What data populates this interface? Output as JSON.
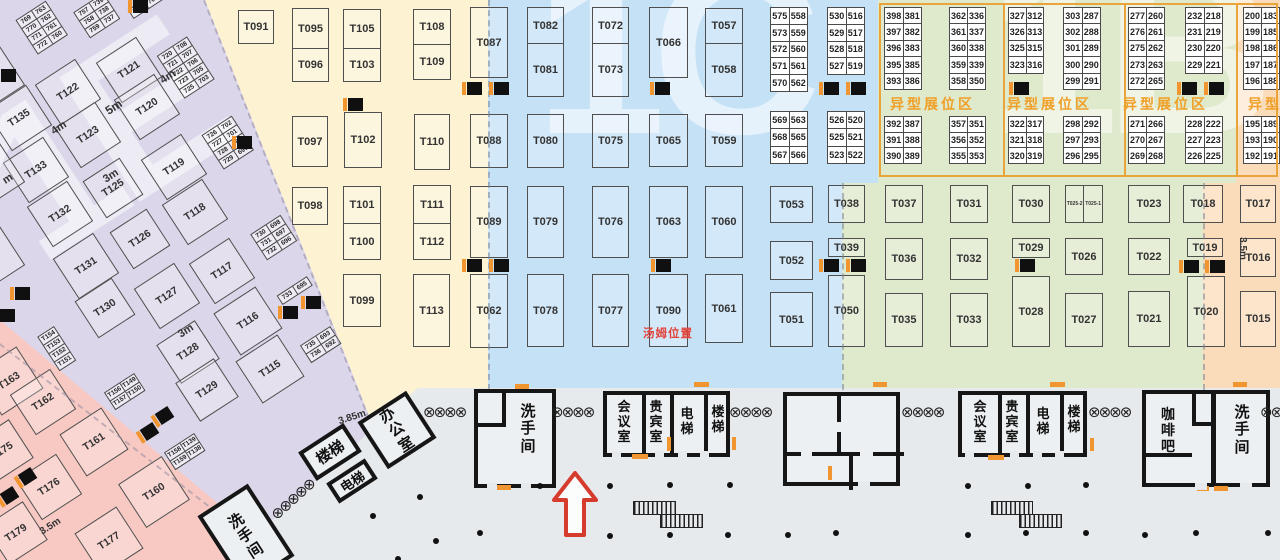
{
  "title": "exhibition-hall-floorplan",
  "tom_label": "汤姆位置",
  "watermarks": [
    "1E",
    "1C",
    "1B"
  ],
  "special_zone_label": "异型展位区",
  "special_labels": [
    [
      890,
      94
    ],
    [
      1007,
      94
    ],
    [
      1123,
      94
    ],
    [
      1248,
      94
    ]
  ],
  "zones": [
    {
      "name": "left-hall-purple",
      "color": "#dbd6e9"
    },
    {
      "name": "left-corner-pink",
      "color": "#f8c9c3"
    },
    {
      "name": "yellow-zone",
      "color": "#fdf3d3"
    },
    {
      "name": "blue-zone-1c",
      "color": "#c5e1f6"
    },
    {
      "name": "green-zone",
      "color": "#dfe9cb"
    },
    {
      "name": "orange-zone-1b",
      "color": "#fbdcba"
    },
    {
      "name": "walkway-gray",
      "color": "#e7eaed"
    },
    {
      "name": "accent-orange",
      "color": "#f0952f"
    },
    {
      "name": "marker-red",
      "color": "#e2443b"
    }
  ],
  "booths": [
    [
      "T091",
      238,
      10,
      36,
      34
    ],
    [
      "T097",
      292,
      116,
      36,
      51
    ],
    [
      "T102",
      344,
      112,
      38,
      56
    ],
    [
      "T110",
      414,
      114,
      36,
      56
    ],
    [
      "T098",
      292,
      187,
      36,
      38
    ],
    [
      "T099",
      343,
      274,
      38,
      53
    ],
    [
      "T113",
      413,
      274,
      37,
      73
    ],
    [
      "T087",
      470,
      7,
      38,
      71
    ],
    [
      "T088",
      470,
      114,
      38,
      54
    ],
    [
      "T089",
      470,
      186,
      38,
      72
    ],
    [
      "T062",
      470,
      274,
      38,
      74
    ],
    [
      "T080",
      527,
      114,
      37,
      54
    ],
    [
      "T079",
      527,
      186,
      37,
      72
    ],
    [
      "T078",
      527,
      274,
      37,
      73
    ],
    [
      "T075",
      592,
      114,
      37,
      54
    ],
    [
      "T076",
      592,
      186,
      37,
      72
    ],
    [
      "T077",
      592,
      274,
      37,
      73
    ],
    [
      "T066",
      649,
      7,
      39,
      71
    ],
    [
      "T065",
      649,
      114,
      39,
      53
    ],
    [
      "T063",
      649,
      186,
      39,
      72
    ],
    [
      "T090",
      649,
      274,
      39,
      73
    ],
    [
      "T059",
      705,
      114,
      38,
      53
    ],
    [
      "T060",
      705,
      186,
      38,
      72
    ],
    [
      "T061",
      705,
      274,
      38,
      69
    ],
    [
      "T053",
      770,
      186,
      43,
      37
    ],
    [
      "T052",
      770,
      241,
      43,
      39
    ],
    [
      "T051",
      770,
      292,
      43,
      55
    ],
    [
      "T038",
      828,
      185,
      37,
      38
    ],
    [
      "T039",
      828,
      238,
      37,
      19
    ],
    [
      "T050",
      828,
      275,
      37,
      72
    ],
    [
      "T037",
      885,
      185,
      38,
      38
    ],
    [
      "T036",
      885,
      238,
      38,
      42
    ],
    [
      "T035",
      885,
      293,
      38,
      54
    ],
    [
      "T031",
      950,
      185,
      38,
      38
    ],
    [
      "T032",
      950,
      238,
      38,
      42
    ],
    [
      "T033",
      950,
      293,
      38,
      54
    ],
    [
      "T030",
      1012,
      185,
      38,
      38
    ],
    [
      "T029",
      1012,
      238,
      38,
      20
    ],
    [
      "T028",
      1012,
      276,
      38,
      71
    ],
    [
      "T026",
      1065,
      238,
      38,
      37
    ],
    [
      "T027",
      1065,
      293,
      38,
      54
    ],
    [
      "T023",
      1128,
      185,
      42,
      38
    ],
    [
      "T022",
      1128,
      238,
      42,
      37
    ],
    [
      "T021",
      1128,
      291,
      42,
      56
    ],
    [
      "T018",
      1183,
      185,
      40,
      38
    ],
    [
      "T019",
      1187,
      238,
      36,
      19
    ],
    [
      "T020",
      1187,
      276,
      38,
      71
    ],
    [
      "T017",
      1240,
      185,
      36,
      38
    ],
    [
      "T016",
      1240,
      238,
      36,
      39
    ],
    [
      "T015",
      1240,
      291,
      36,
      56
    ]
  ],
  "booth_pairs": [
    [
      "T095",
      "T096",
      292,
      8,
      37,
      74,
      40
    ],
    [
      "T105",
      "T103",
      343,
      9,
      38,
      73,
      39
    ],
    [
      "T108",
      "T109",
      413,
      9,
      38,
      71,
      35
    ],
    [
      "T101",
      "T100",
      343,
      186,
      38,
      74,
      37
    ],
    [
      "T111",
      "T112",
      413,
      185,
      38,
      75,
      38
    ],
    [
      "T082",
      "T081",
      527,
      7,
      37,
      90,
      36
    ],
    [
      "T072",
      "T073",
      592,
      7,
      37,
      90,
      36
    ],
    [
      "T057",
      "T058",
      705,
      8,
      38,
      89,
      35
    ]
  ],
  "booth_hpair": [
    "T025-2",
    "T025-1",
    1065,
    185,
    38,
    38
  ],
  "rot_booths": [
    [
      "T121",
      129,
      70,
      48
    ],
    [
      "T122",
      68,
      92,
      48
    ],
    [
      "T120",
      147,
      107,
      48
    ],
    [
      "T135",
      19,
      118,
      48
    ],
    [
      "T123",
      88,
      135,
      48
    ],
    [
      "T133",
      36,
      170,
      48
    ],
    [
      "T119",
      174,
      167,
      48
    ],
    [
      "T125",
      113,
      188,
      44
    ],
    [
      "T132",
      60,
      214,
      48
    ],
    [
      "T118",
      195,
      212,
      48
    ],
    [
      "T126",
      140,
      239,
      44
    ],
    [
      "T131",
      86,
      266,
      48
    ],
    [
      "T117",
      222,
      271,
      48
    ],
    [
      "T127",
      167,
      296,
      48
    ],
    [
      "T130",
      105,
      308,
      44
    ],
    [
      "T128",
      188,
      352,
      46
    ],
    [
      "T129",
      207,
      390,
      46
    ],
    [
      "T116",
      248,
      321,
      50
    ],
    [
      "T115",
      270,
      369,
      50
    ],
    [
      "",
      -8,
      78,
      48
    ],
    [
      "",
      -8,
      175,
      48
    ],
    [
      "",
      -8,
      258,
      48
    ],
    [
      "T163",
      9,
      381,
      50
    ],
    [
      "T162",
      43,
      402,
      48
    ],
    [
      "T161",
      94,
      442,
      50
    ],
    [
      "T160",
      154,
      492,
      52
    ],
    [
      "T175",
      2,
      451,
      46
    ],
    [
      "T176",
      49,
      487,
      48
    ],
    [
      "T179",
      16,
      533,
      46
    ],
    [
      "T177",
      109,
      541,
      50
    ]
  ],
  "rot_strips": [
    [
      42,
      28,
      [
        "769|763",
        "770|762",
        "771|761",
        "772|760"
      ]
    ],
    [
      97,
      16,
      [
        "757|739",
        "758|738",
        "759|737"
      ]
    ],
    [
      146,
      5,
      [
        "719|709"
      ]
    ],
    [
      186,
      68,
      [
        "720|708",
        "721|707",
        "722|706",
        "723|705",
        "725|703"
      ]
    ],
    [
      228,
      143,
      [
        "726|702",
        "727|701",
        "728|700",
        "729|699"
      ]
    ],
    [
      274,
      238,
      [
        "730|698",
        "731|697",
        "732|696"
      ]
    ],
    [
      295,
      291,
      [
        "733|695"
      ]
    ],
    [
      321,
      345,
      [
        "735|693",
        "736|692"
      ]
    ],
    [
      57,
      349,
      [
        "T154",
        "T153",
        "T152",
        "T151"
      ]
    ],
    [
      125,
      392,
      [
        "T156|T149",
        "T157|T150"
      ]
    ],
    [
      185,
      452,
      [
        "T158|T139",
        "T159|T138"
      ]
    ]
  ],
  "num_blocks": [
    [
      770,
      8,
      38,
      17.8,
      [
        "575|558",
        "573|559",
        "572|560",
        "571|561",
        "570|562"
      ]
    ],
    [
      827,
      8,
      38,
      17.8,
      [
        "530|516",
        "529|517",
        "528|518",
        "527|519"
      ]
    ],
    [
      770,
      112,
      38,
      18.3,
      [
        "569|563",
        "568|565",
        "567|566"
      ]
    ],
    [
      827,
      112,
      38,
      18.3,
      [
        "526|520",
        "525|521",
        "523|522"
      ]
    ],
    [
      884,
      8,
      38,
      17.4,
      [
        "398|381",
        "397|382",
        "396|383",
        "395|385",
        "393|386"
      ]
    ],
    [
      949,
      8,
      37,
      17.4,
      [
        "362|336",
        "361|337",
        "360|338",
        "359|339",
        "358|350"
      ]
    ],
    [
      1008,
      8,
      36,
      17.4,
      [
        "327|312",
        "326|313",
        "325|315",
        "323|316"
      ]
    ],
    [
      1063,
      8,
      38,
      17.4,
      [
        "303|287",
        "302|288",
        "301|289",
        "300|290",
        "299|291"
      ]
    ],
    [
      1128,
      8,
      37,
      17.4,
      [
        "277|260",
        "276|261",
        "275|262",
        "273|263",
        "272|265"
      ]
    ],
    [
      1185,
      8,
      38,
      17.4,
      [
        "232|218",
        "231|219",
        "230|220",
        "229|221"
      ]
    ],
    [
      1243,
      8,
      37,
      17.4,
      [
        "200|183",
        "199|185",
        "198|186",
        "197|187",
        "196|188"
      ]
    ],
    [
      884,
      117,
      38,
      16.7,
      [
        "392|387",
        "391|388",
        "390|389"
      ]
    ],
    [
      949,
      117,
      37,
      16.7,
      [
        "357|351",
        "356|352",
        "355|353"
      ]
    ],
    [
      1008,
      117,
      36,
      16.7,
      [
        "322|317",
        "321|318",
        "320|319"
      ]
    ],
    [
      1063,
      117,
      38,
      16.7,
      [
        "298|292",
        "297|293",
        "296|295"
      ]
    ],
    [
      1128,
      117,
      37,
      16.7,
      [
        "271|266",
        "270|267",
        "269|268"
      ]
    ],
    [
      1185,
      117,
      38,
      16.7,
      [
        "228|222",
        "227|223",
        "226|225"
      ]
    ],
    [
      1243,
      117,
      37,
      16.7,
      [
        "195|189",
        "193|190",
        "192|191"
      ]
    ]
  ],
  "pillars": [
    [
      133,
      0
    ],
    [
      1,
      69
    ],
    [
      15,
      287
    ],
    [
      0,
      309
    ],
    [
      237,
      136
    ],
    [
      283,
      306
    ],
    [
      306,
      296
    ],
    [
      348,
      98
    ],
    [
      467,
      82
    ],
    [
      494,
      82
    ],
    [
      655,
      82
    ],
    [
      824,
      82
    ],
    [
      851,
      82
    ],
    [
      1014,
      82
    ],
    [
      1182,
      82
    ],
    [
      1209,
      82
    ],
    [
      467,
      259
    ],
    [
      494,
      259
    ],
    [
      656,
      259
    ],
    [
      824,
      259
    ],
    [
      851,
      259
    ],
    [
      1020,
      259
    ],
    [
      1184,
      260
    ],
    [
      1210,
      260
    ]
  ],
  "rot_pillars": [
    [
      20,
      470
    ],
    [
      142,
      425
    ],
    [
      157,
      409
    ],
    [
      2,
      489
    ]
  ],
  "rooms": {
    "rot_rooms": [
      {
        "label": "办公室",
        "cx": 397,
        "cy": 430,
        "w": 58,
        "h": 56,
        "fs": 15,
        "vert": true
      },
      {
        "label": "楼梯",
        "cx": 330,
        "cy": 452,
        "w": 54,
        "h": 34,
        "fs": 15,
        "vert": false
      },
      {
        "label": "电梯",
        "cx": 352,
        "cy": 481,
        "w": 46,
        "h": 24,
        "fs": 13,
        "vert": false
      },
      {
        "label": "洗手间",
        "cx": 246,
        "cy": 536,
        "w": 60,
        "h": 86,
        "fs": 15,
        "vert": true
      }
    ],
    "blocks": [
      {
        "x": 474,
        "y": 389,
        "w": 82,
        "h": 99,
        "walls": [
          [
            24,
            0,
            4,
            34
          ],
          [
            0,
            30,
            24,
            4
          ]
        ],
        "labels": [
          [
            "洗手间",
            42,
            10,
            15
          ]
        ]
      },
      {
        "x": 603,
        "y": 391,
        "w": 127,
        "h": 66,
        "walls": [
          [
            35,
            0,
            4,
            58
          ],
          [
            63,
            0,
            4,
            58
          ],
          [
            97,
            0,
            4,
            58
          ]
        ],
        "labels": [
          [
            "会议室",
            9,
            5,
            13
          ],
          [
            "贵宾室",
            41,
            5,
            13
          ],
          [
            "电梯",
            72,
            12,
            13
          ],
          [
            "楼梯",
            103,
            10,
            13
          ]
        ]
      },
      {
        "x": 783,
        "y": 392,
        "w": 117,
        "h": 94,
        "walls": [
          [
            50,
            0,
            4,
            26
          ],
          [
            50,
            36,
            4,
            22
          ],
          [
            0,
            56,
            14,
            4
          ],
          [
            25,
            56,
            48,
            4
          ],
          [
            86,
            56,
            31,
            4
          ],
          [
            62,
            60,
            4,
            34
          ]
        ],
        "labels": []
      },
      {
        "x": 958,
        "y": 391,
        "w": 129,
        "h": 66,
        "walls": [
          [
            36,
            0,
            4,
            58
          ],
          [
            64,
            0,
            4,
            58
          ],
          [
            98,
            0,
            4,
            58
          ]
        ],
        "labels": [
          [
            "会议室",
            10,
            5,
            13
          ],
          [
            "贵宾室",
            42,
            5,
            13
          ],
          [
            "电梯",
            73,
            12,
            13
          ],
          [
            "楼梯",
            104,
            10,
            13
          ]
        ]
      },
      {
        "x": 1142,
        "y": 390,
        "w": 73,
        "h": 97,
        "walls": [
          [
            46,
            0,
            4,
            31
          ],
          [
            46,
            28,
            27,
            4
          ],
          [
            0,
            59,
            46,
            4
          ]
        ],
        "labels": [
          [
            "咖啡吧",
            14,
            12,
            14
          ]
        ]
      },
      {
        "x": 1212,
        "y": 390,
        "w": 58,
        "h": 97,
        "walls": [],
        "labels": [
          [
            "洗手间",
            18,
            10,
            15
          ]
        ]
      }
    ]
  },
  "doors": [
    [
      515,
      384,
      14,
      5
    ],
    [
      497,
      485,
      14,
      5
    ],
    [
      694,
      382,
      15,
      5
    ],
    [
      632,
      454,
      16,
      5
    ],
    [
      873,
      382,
      14,
      5
    ],
    [
      828,
      466,
      4,
      14
    ],
    [
      1050,
      382,
      15,
      5
    ],
    [
      988,
      455,
      16,
      5
    ],
    [
      1233,
      382,
      14,
      5
    ],
    [
      1214,
      486,
      14,
      5
    ],
    [
      1197,
      486,
      12,
      5
    ],
    [
      667,
      437,
      4,
      14
    ],
    [
      732,
      437,
      4,
      13
    ],
    [
      1090,
      438,
      4,
      13
    ]
  ],
  "gaps": [
    [
      612,
      451,
      9,
      7
    ],
    [
      655,
      451,
      9,
      7
    ],
    [
      678,
      451,
      9,
      7
    ],
    [
      700,
      451,
      9,
      7
    ],
    [
      965,
      451,
      9,
      7
    ],
    [
      1010,
      451,
      9,
      7
    ],
    [
      1033,
      451,
      9,
      7
    ],
    [
      1055,
      451,
      9,
      7
    ],
    [
      487,
      483,
      10,
      7
    ],
    [
      521,
      483,
      10,
      7
    ],
    [
      858,
      481,
      12,
      7
    ],
    [
      1240,
      483,
      12,
      7
    ],
    [
      1195,
      483,
      12,
      7
    ]
  ],
  "chains": [
    [
      423,
      403,
      4,
      0
    ],
    [
      551,
      403,
      4,
      0
    ],
    [
      729,
      403,
      4,
      0
    ],
    [
      901,
      403,
      4,
      0
    ],
    [
      1088,
      403,
      4,
      0
    ],
    [
      1260,
      403,
      2,
      0
    ],
    [
      273,
      508,
      5,
      -42
    ]
  ],
  "dots": [
    [
      417,
      494
    ],
    [
      370,
      513
    ],
    [
      395,
      556
    ],
    [
      433,
      538
    ],
    [
      477,
      530
    ],
    [
      537,
      483
    ],
    [
      607,
      483
    ],
    [
      667,
      482
    ],
    [
      727,
      482
    ],
    [
      607,
      533
    ],
    [
      667,
      532
    ],
    [
      725,
      532
    ],
    [
      785,
      532
    ],
    [
      833,
      530
    ],
    [
      965,
      483
    ],
    [
      1025,
      483
    ],
    [
      1083,
      482
    ],
    [
      965,
      532
    ],
    [
      1023,
      530
    ],
    [
      1083,
      530
    ],
    [
      1142,
      532
    ],
    [
      1193,
      530
    ],
    [
      1265,
      530
    ]
  ],
  "escalators": [
    [
      633,
      501,
      41,
      12
    ],
    [
      660,
      514,
      41,
      12
    ],
    [
      991,
      501,
      40,
      12
    ],
    [
      1019,
      514,
      41,
      12
    ]
  ],
  "dim_labels": [
    [
      "4m",
      160,
      71,
      -33,
      11
    ],
    [
      "5m",
      105,
      100,
      -33,
      12
    ],
    [
      "4m",
      51,
      122,
      -33,
      11
    ],
    [
      "3m",
      103,
      170,
      -33,
      11
    ],
    [
      "3m",
      178,
      325,
      -33,
      11
    ],
    [
      "3.5m",
      39,
      521,
      -33,
      10
    ],
    [
      "m",
      3,
      173,
      -33,
      11
    ],
    [
      "3.85m",
      338,
      412,
      -18,
      10
    ],
    [
      "3.5m",
      1231,
      243,
      90,
      10
    ]
  ]
}
